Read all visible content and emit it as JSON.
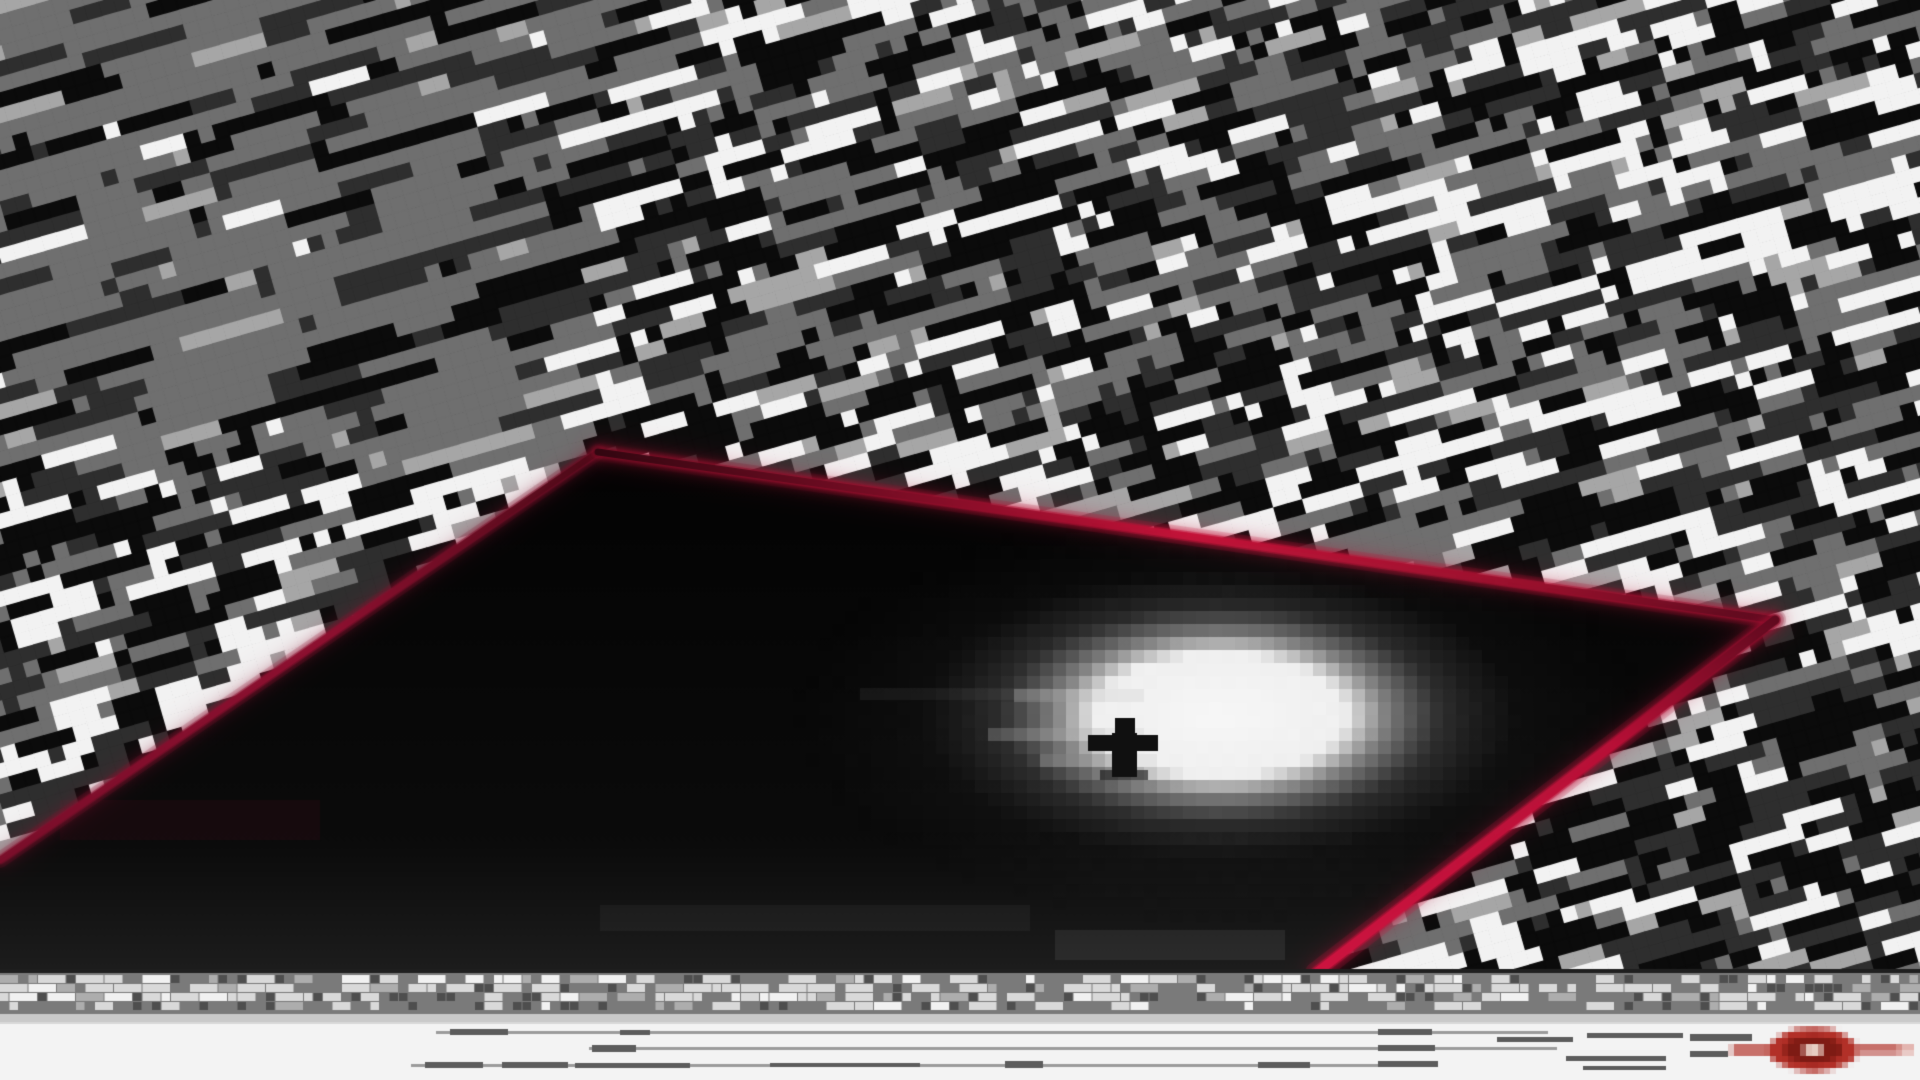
{
  "canvas": {
    "width": 1920,
    "height": 1080
  },
  "palette": {
    "black": "#0b0b0b",
    "dark_gray": "#2e2e2e",
    "mid_gray": "#6f6f6f",
    "light_gray": "#a6a6a6",
    "white": "#f2f2f2",
    "accent_red_bright": "#c41238",
    "accent_red_mid": "#8e1030",
    "accent_red_dark": "#3a0714"
  },
  "background": {
    "cell_size": 15,
    "angle_deg": -16,
    "seed": 20240601,
    "band_period_rows": 8,
    "colors": {
      "black": "#0b0b0b",
      "dark": "#2e2e2e",
      "mid": "#6f6f6f",
      "light": "#a6a6a6",
      "white": "#f2f2f2"
    }
  },
  "pit": {
    "polygon": [
      [
        598,
        452
      ],
      [
        1775,
        620
      ],
      [
        1316,
        973
      ],
      [
        0,
        973
      ],
      [
        0,
        860
      ]
    ],
    "fill_top": "#030303",
    "fill_mid": "#0b0b0b",
    "fill_bottom": "#1d1d1d",
    "edges": [
      {
        "name": "top-left",
        "from": [
          598,
          452
        ],
        "to": [
          0,
          860
        ],
        "width": 6,
        "glow": 16,
        "stops": [
          [
            0,
            "#4a0916"
          ],
          [
            0.45,
            "#8e1030"
          ],
          [
            1,
            "#7a0e2a"
          ]
        ]
      },
      {
        "name": "top-right",
        "from": [
          598,
          452
        ],
        "to": [
          1775,
          620
        ],
        "width": 7,
        "glow": 18,
        "stops": [
          [
            0,
            "#2e060f"
          ],
          [
            0.22,
            "#6f0c22"
          ],
          [
            0.5,
            "#c41238"
          ],
          [
            0.8,
            "#97102c"
          ],
          [
            1,
            "#550a1c"
          ]
        ]
      },
      {
        "name": "bottom-right",
        "from": [
          1775,
          620
        ],
        "to": [
          1316,
          973
        ],
        "width": 9,
        "glow": 22,
        "stops": [
          [
            0,
            "#5e0a1e"
          ],
          [
            0.35,
            "#b80f36"
          ],
          [
            1,
            "#ce1440"
          ]
        ]
      }
    ],
    "smudges": [
      {
        "rect": [
          860,
          688,
          190,
          12
        ],
        "color": "rgba(255,255,255,0.05)"
      },
      {
        "rect": [
          600,
          905,
          430,
          26
        ],
        "color": "rgba(255,255,255,0.04)"
      },
      {
        "rect": [
          1055,
          930,
          230,
          30
        ],
        "color": "rgba(255,255,255,0.07)"
      },
      {
        "rect": [
          60,
          800,
          260,
          40
        ],
        "color": "rgba(142,16,48,0.10)"
      }
    ]
  },
  "light": {
    "center": [
      1220,
      715
    ],
    "radius_x": 165,
    "radius_y": 80,
    "pixel_size": 13,
    "core_color": "#ffffff",
    "halo_alpha": 0.15,
    "streaks": [
      [
        78,
        53,
        10,
        1
      ],
      [
        76,
        56,
        12,
        1
      ],
      [
        80,
        58,
        9,
        1
      ]
    ]
  },
  "figure": {
    "color": "#101010",
    "head": [
      1115,
      718,
      20,
      15
    ],
    "arms": [
      1088,
      735,
      70,
      16
    ],
    "body": [
      1112,
      733,
      25,
      44
    ],
    "base": [
      1100,
      770,
      48,
      10
    ],
    "base_alpha": 0.6
  },
  "caption_strip": {
    "top_edge": {
      "y": 969,
      "h": 4,
      "color": "#1f1f1f"
    },
    "band": {
      "y": 973,
      "h": 43,
      "color": "#7a7a7a"
    },
    "bottom_edge": {
      "y": 1014,
      "h": 8,
      "color": "#c9c9c9"
    },
    "mosaic": {
      "seed": 99,
      "cell": 9.5,
      "rows_y": [
        975,
        984,
        993,
        1002
      ],
      "row_bright_prob": [
        0.34,
        0.46,
        0.44,
        0.22
      ],
      "bright_colors": [
        [
          "#d9d9d9",
          0.55
        ],
        [
          "#f1f1f1",
          0.25
        ],
        [
          "#adadad",
          0.2
        ]
      ],
      "dark_prob": 0.15,
      "dark_color": "#4e4e4e"
    }
  },
  "footer": {
    "bg": "#f3f3f3",
    "y": 1022,
    "h": 58,
    "hairline": "#d8d8d8",
    "line_colors": {
      "a": "#9b9b9b",
      "b": "#5c5c5c"
    },
    "lines": [
      {
        "x": 436,
        "y": 1031,
        "w": 1112,
        "h": 3,
        "c": "a"
      },
      {
        "x": 450,
        "y": 1029,
        "w": 58,
        "h": 6,
        "c": "b"
      },
      {
        "x": 620,
        "y": 1030,
        "w": 30,
        "h": 5,
        "c": "b"
      },
      {
        "x": 589,
        "y": 1047,
        "w": 968,
        "h": 3,
        "c": "a"
      },
      {
        "x": 592,
        "y": 1045,
        "w": 44,
        "h": 7,
        "c": "b"
      },
      {
        "x": 411,
        "y": 1064,
        "w": 1020,
        "h": 3,
        "c": "a"
      },
      {
        "x": 425,
        "y": 1062,
        "w": 58,
        "h": 6,
        "c": "b"
      },
      {
        "x": 502,
        "y": 1062,
        "w": 66,
        "h": 6,
        "c": "b"
      },
      {
        "x": 575,
        "y": 1063,
        "w": 115,
        "h": 5,
        "c": "b"
      },
      {
        "x": 770,
        "y": 1063,
        "w": 150,
        "h": 4,
        "c": "b"
      },
      {
        "x": 1005,
        "y": 1061,
        "w": 38,
        "h": 7,
        "c": "b"
      },
      {
        "x": 1258,
        "y": 1062,
        "w": 52,
        "h": 6,
        "c": "b"
      },
      {
        "x": 1378,
        "y": 1029,
        "w": 54,
        "h": 6,
        "c": "b"
      },
      {
        "x": 1378,
        "y": 1045,
        "w": 57,
        "h": 6,
        "c": "b"
      },
      {
        "x": 1378,
        "y": 1061,
        "w": 60,
        "h": 6,
        "c": "b"
      },
      {
        "x": 1497,
        "y": 1037,
        "w": 76,
        "h": 5,
        "c": "b"
      },
      {
        "x": 1587,
        "y": 1033,
        "w": 96,
        "h": 5,
        "c": "b"
      },
      {
        "x": 1566,
        "y": 1056,
        "w": 100,
        "h": 5,
        "c": "b"
      },
      {
        "x": 1583,
        "y": 1066,
        "w": 83,
        "h": 4,
        "c": "b"
      },
      {
        "x": 1690,
        "y": 1034,
        "w": 62,
        "h": 7,
        "c": "b"
      },
      {
        "x": 1690,
        "y": 1051,
        "w": 38,
        "h": 6,
        "c": "b"
      }
    ],
    "logo": {
      "pixel_size": 6,
      "cx": 1813,
      "cy": 1050,
      "rx": 45,
      "ry": 22,
      "body_color": "#b23028",
      "ring_rx": 29,
      "ring_ry": 13,
      "ring_color": "#7e1b14",
      "dot_rx": 11,
      "dot_ry": 6,
      "dot_color": "#eed8cd",
      "left_bar": [
        1732,
        1046,
        42,
        8
      ],
      "right_bar": [
        1856,
        1046,
        44,
        7
      ],
      "right_stub": [
        1898,
        1047,
        16,
        5
      ],
      "bar_color": "#b23028",
      "stub_color": "#d4786e"
    }
  }
}
